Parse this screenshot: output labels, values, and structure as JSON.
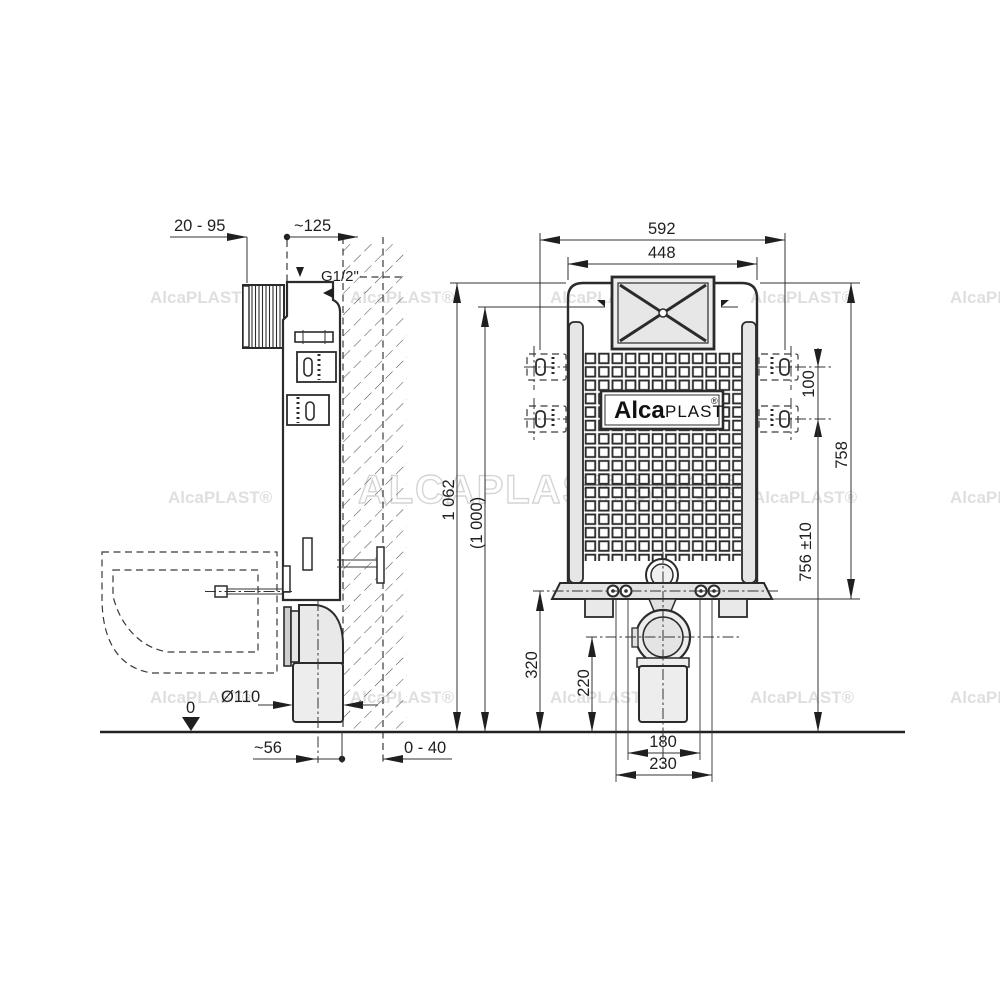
{
  "watermarks": {
    "small": "AlcaPLAST®",
    "big": "ALCAPLAST.SHOP"
  },
  "logo": {
    "alca": "Alca",
    "plast": "PLAST",
    "registered": "®"
  },
  "side_view": {
    "dims": {
      "wall_offset": "20 - 95",
      "depth": "~125",
      "water_connection": "G1/2\"",
      "drain_diameter": "Ø110",
      "floor_level": "0",
      "outlet_to_wall": "~56",
      "wall_finish": "0 - 40"
    }
  },
  "front_view": {
    "dims": {
      "width_outer": "592",
      "width_inner": "448",
      "height_total": "1 062",
      "height_recommended": "(1 000)",
      "bracket_spacing": "100",
      "body_height": "758",
      "rod_height": "756 ±10",
      "flange_height": "320",
      "outlet_height": "220",
      "bolt_spacing_inner": "180",
      "bolt_spacing_outer": "230"
    }
  }
}
